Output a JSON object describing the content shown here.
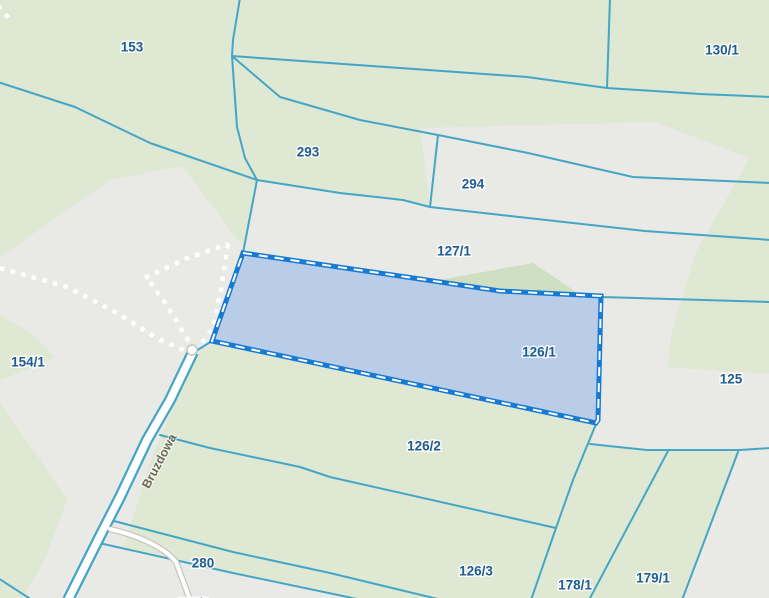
{
  "map": {
    "type": "cadastral-parcel-map",
    "selected_parcel": {
      "label": "126/1",
      "x": 539,
      "y": 352
    },
    "parcel_labels": [
      {
        "text": "153",
        "x": 132,
        "y": 47
      },
      {
        "text": "130/1",
        "x": 722,
        "y": 50
      },
      {
        "text": "293",
        "x": 308,
        "y": 152
      },
      {
        "text": "294",
        "x": 473,
        "y": 184
      },
      {
        "text": "127/1",
        "x": 454,
        "y": 251
      },
      {
        "text": "126/1",
        "x": 539,
        "y": 352
      },
      {
        "text": "154/1",
        "x": 28,
        "y": 362
      },
      {
        "text": "125",
        "x": 731,
        "y": 379
      },
      {
        "text": "126/2",
        "x": 424,
        "y": 446
      },
      {
        "text": "280",
        "x": 203,
        "y": 563
      },
      {
        "text": "126/3",
        "x": 476,
        "y": 571
      },
      {
        "text": "178/1",
        "x": 575,
        "y": 585
      },
      {
        "text": "179/1",
        "x": 653,
        "y": 578
      },
      {
        "text": "177/2",
        "x": 193,
        "y": 603
      }
    ],
    "street_label": {
      "text": "Bruzdowa",
      "x": 159,
      "y": 461,
      "rotate": -62
    },
    "colors": {
      "background_green": "#dee8d3",
      "accent_green": "#cfe0c2",
      "cover_gray": "#e9e9e6",
      "boundary_blue": "#44a6c6",
      "selection_border": "#177bd3",
      "selection_fill": "#b9cde9",
      "label_blue": "#1f5c92",
      "street_label": "#6f6a58",
      "trail_white": "#ffffff"
    }
  }
}
